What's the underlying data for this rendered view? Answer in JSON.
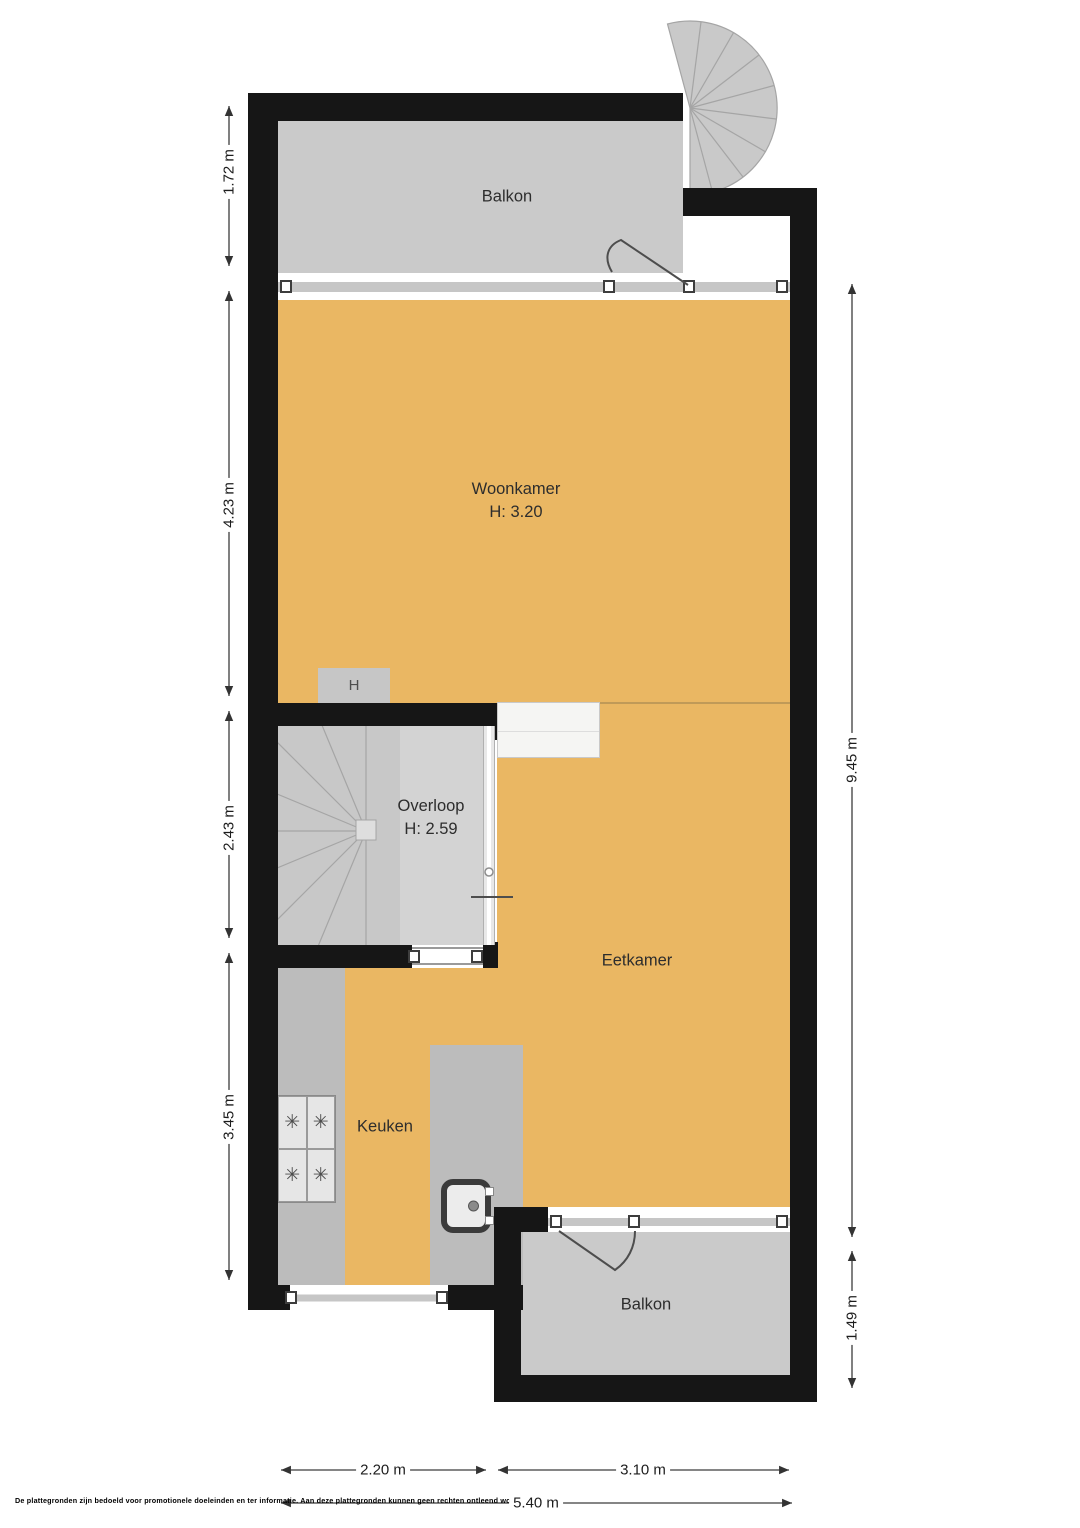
{
  "plan": {
    "rooms": {
      "balkon_top": "Balkon",
      "woonkamer": "Woonkamer",
      "woonkamer_height": "H: 3.20",
      "overloop": "Overloop",
      "overloop_height": "H: 2.59",
      "eetkamer": "Eetkamer",
      "keuken": "Keuken",
      "balkon_bottom": "Balkon",
      "heater_unit": "H"
    },
    "dimensions": {
      "left": [
        "1.72 m",
        "4.23 m",
        "2.43 m",
        "3.45 m"
      ],
      "right": [
        "9.45 m",
        "1.49 m"
      ],
      "bottom": [
        "2.20 m",
        "3.10 m",
        "5.40 m"
      ]
    },
    "disclaimer": "De plattegronden zijn bedoeld voor promotionele doeleinden en ter informatie. Aan deze plattegronden kunnen geen rechten ontleend worden.",
    "colors": {
      "floor": "#EAB763",
      "balcony_gray": "#CACACA",
      "overloop_gray": "#D3D3D3",
      "stair_gray": "#C8C8C8",
      "counter_gray": "#BCBCBC",
      "wall": "#161616"
    }
  }
}
